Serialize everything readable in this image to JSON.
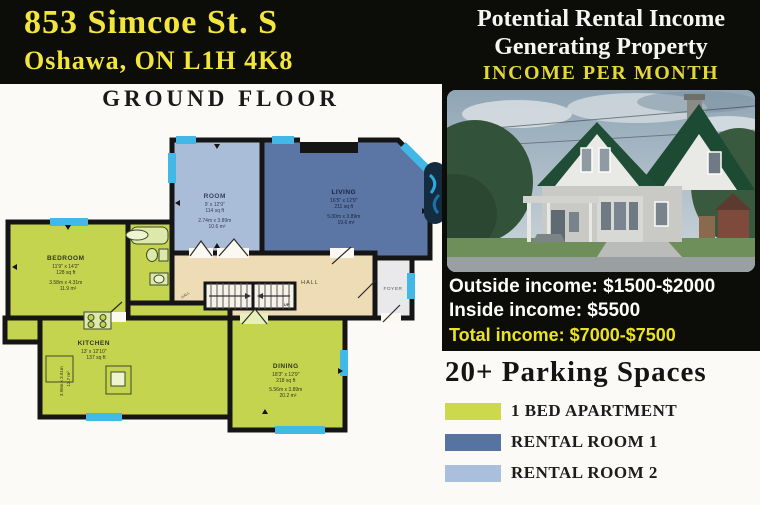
{
  "address": {
    "line1": "853 Simcoe St. S",
    "line2": "Oshawa, ON L1H 4K8"
  },
  "right_header": {
    "line1": "Potential Rental Income",
    "line2": "Generating Property",
    "line3": "INCOME PER MONTH"
  },
  "income": {
    "outside": "Outside income: $1500-$2000",
    "inside": "Inside income: $5500",
    "total": "Total income: $7000-$7500"
  },
  "parking_title": "20+ Parking Spaces",
  "legend": [
    {
      "label": "1 BED APARTMENT",
      "color": "#ccd94d"
    },
    {
      "label": "RENTAL ROOM 1",
      "color": "#5673a2"
    },
    {
      "label": "RENTAL ROOM 2",
      "color": "#aabfdc"
    }
  ],
  "floor_title": "GROUND FLOOR",
  "rooms": {
    "room": {
      "name": "ROOM",
      "dim": "9' x 12'9\"",
      "area": "114 sq ft",
      "dim_m": "2.74m x 3.89m",
      "area_m": "10.6 m²"
    },
    "living": {
      "name": "LIVING",
      "dim": "16'5\" x 12'9\"",
      "area": "211 sq ft",
      "dim_m": "5.00m x 3.89m",
      "area_m": "19.6 m²"
    },
    "bedroom": {
      "name": "BEDROOM",
      "dim": "11'9\" x 14'2\"",
      "area": "128 sq ft",
      "dim_m": "3.58m x 4.31m",
      "area_m": "11.9 m²"
    },
    "kitchen": {
      "name": "KITCHEN",
      "dim": "13' x 12'10\"",
      "area": "137 sq ft",
      "dim_m": "3.96m x 3.91m",
      "area_m": "12.7 m²"
    },
    "dining": {
      "name": "DINING",
      "dim": "18'3\" x 12'9\"",
      "area": "218 sq ft",
      "dim_m": "5.56m x 3.89m",
      "area_m": "20.2 m²"
    },
    "hall_main": "HALL",
    "hall_small": "HALL",
    "foyer": "FOYER",
    "up": "UP"
  },
  "colors": {
    "accent_yellow": "#f2e53c",
    "income_yellow": "#eae31f",
    "apartment_green": "#c5d44e",
    "rental1_blue": "#5b76a4",
    "rental2_blue": "#a9bdd9",
    "hall_beige": "#eedcb7",
    "window_cyan": "#41b8e6",
    "panel_black": "#0c0c09"
  }
}
